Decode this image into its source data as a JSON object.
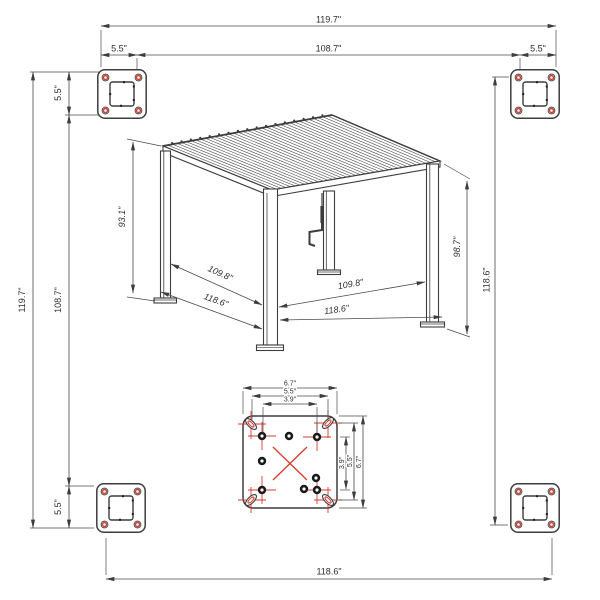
{
  "colors": {
    "line": "#3d3d3d",
    "dim_line": "#4a4a4a",
    "accent_red": "#d93a2e",
    "text": "#2e2e2e",
    "background": "#ffffff"
  },
  "pergola": {
    "louver_count": 36,
    "louver_end_dots": 18
  },
  "dimensions": {
    "top_total": "119.7\"",
    "top_inner": "108.7\"",
    "top_plate_left": "5.5\"",
    "top_plate_right": "5.5\"",
    "left_total": "119.7\"",
    "left_inner": "108.7\"",
    "left_plate_top": "5.5\"",
    "left_plate_bottom": "5.5\"",
    "right_total": "118.6\"",
    "bottom_total": "118.6\"",
    "height_left": "93.1\"",
    "height_right": "98.7\"",
    "span_left_inner": "109.8\"",
    "span_left_outer": "118.6\"",
    "span_right_inner": "109.8\"",
    "span_right_outer": "118.6\"",
    "plate_width_outer": "6.7\"",
    "plate_width_mid": "5.5\"",
    "plate_width_inner": "3.9\"",
    "plate_height_outer": "6.7\"",
    "plate_height_mid": "5.5\"",
    "plate_height_inner": "3.9\""
  }
}
